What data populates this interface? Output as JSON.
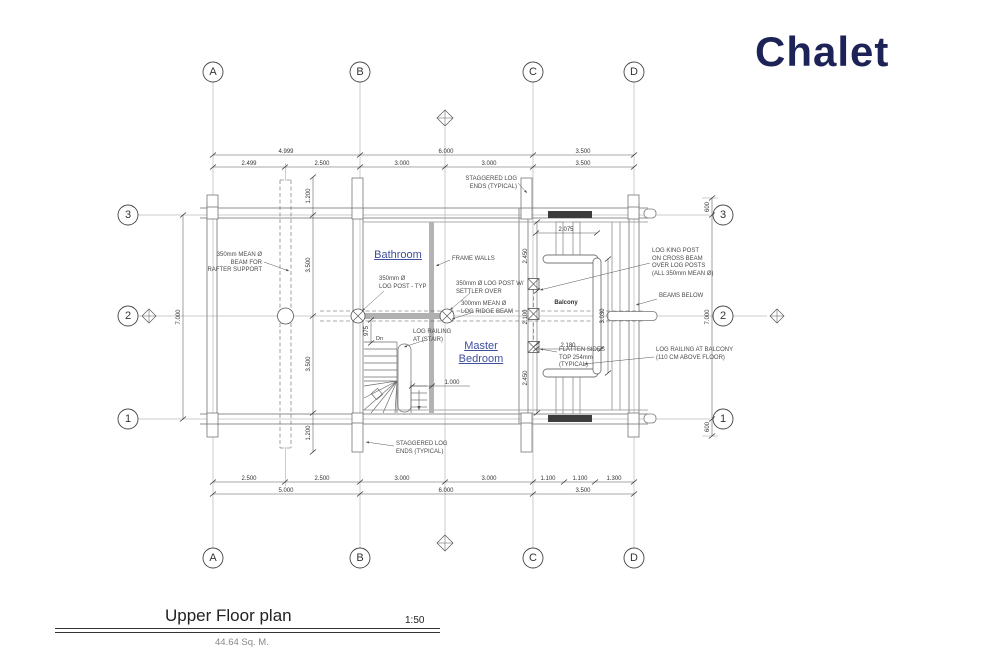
{
  "page": {
    "title": "Chalet",
    "accent_color": "#1e2357"
  },
  "title_block": {
    "name": "Upper Floor plan",
    "scale": "1:50",
    "area": "44.64 Sq. M."
  },
  "grid": {
    "columns": [
      "A",
      "B",
      "C",
      "D"
    ],
    "rows": [
      "3",
      "2",
      "1"
    ]
  },
  "rooms": {
    "bathroom": "Bathroom",
    "master": "Master\nBedroom",
    "balcony": "Balcony",
    "stair_direction": "Dn"
  },
  "dims": {
    "top1": [
      "4.999",
      "6.000",
      "3.500"
    ],
    "top2": [
      "2.499",
      "2.500",
      "3.000",
      "3.000",
      "3.500"
    ],
    "bottom1": [
      "2.500",
      "2.500",
      "3.000",
      "3.000",
      "1.100",
      "1.100",
      "1.300"
    ],
    "bottom2": [
      "5.000",
      "6.000",
      "3.500"
    ],
    "left": [
      "7.000"
    ],
    "right": [
      "600",
      "7.000",
      "600"
    ],
    "interior_left": [
      "1.200",
      "3.500",
      "3.500",
      "1.200"
    ],
    "stair": [
      "975",
      "1.000"
    ],
    "balcony": [
      "2.075",
      "2.180",
      "3.030"
    ],
    "bedroom": [
      "2.450",
      "2.100",
      "2.450"
    ]
  },
  "annotations": {
    "rafter_beam": "350mm MEAN Ø\nBEAM FOR\nRAFTER SUPPORT",
    "staggered_top": "STAGGERED LOG\nENDS (TYPICAL)",
    "frame_walls": "FRAME WALLS",
    "log_post_typ": "350mm Ø\nLOG POST - TYP",
    "settler": "350mm Ø LOG POST W/\nSETTLER OVER",
    "ridge": "300mm MEAN Ø\nLOG RIDGE BEAM",
    "stair_rail": "LOG RAILING\nAT (STAIR)",
    "king_post": "LOG KING POST\nON CROSS BEAM\nOVER LOG POSTS\n(ALL 350mm MEAN Ø)",
    "beams_below": "BEAMS BELOW",
    "flatten": "FLATTEN SIDES\nTOP 254mm\n(TYPICAL)",
    "balcony_rail": "LOG RAILING AT BALCONY\n(110 CM ABOVE FLOOR)",
    "staggered_bottom": "STAGGERED LOG\nENDS (TYPICAL)"
  }
}
